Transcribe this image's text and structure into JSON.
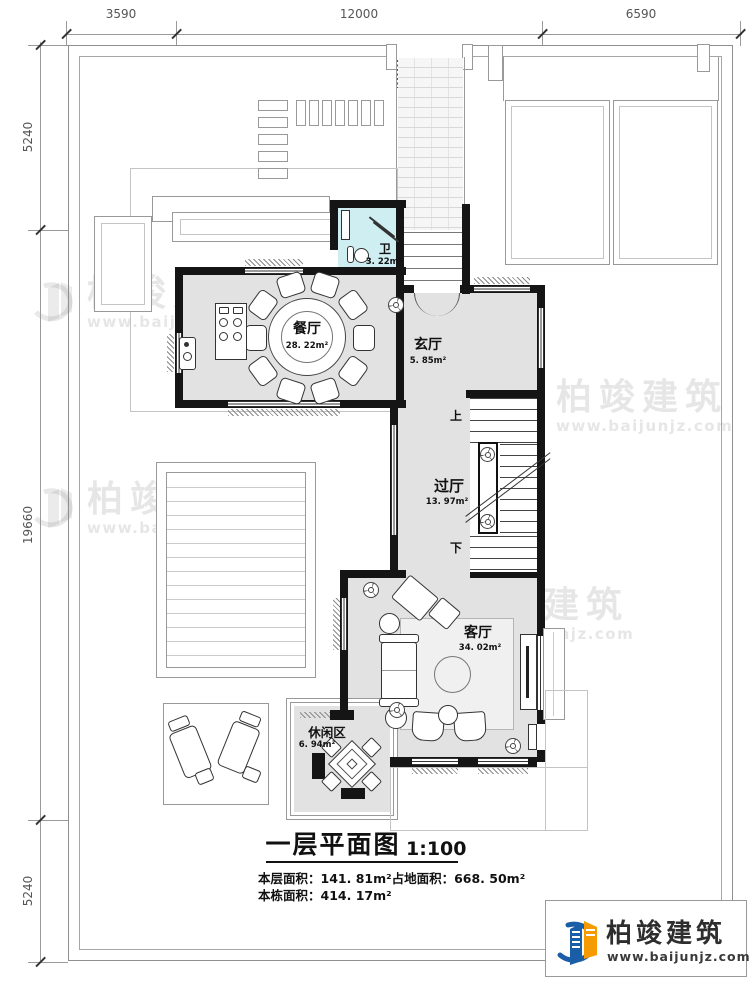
{
  "plan": {
    "dimensions_top": [
      {
        "label": "3590"
      },
      {
        "label": "12000"
      },
      {
        "label": "6590"
      }
    ],
    "dimensions_left": [
      {
        "label": "5240"
      },
      {
        "label": "19660"
      },
      {
        "label": "5240"
      }
    ],
    "rooms": {
      "dining": {
        "name": "餐厅",
        "area": "28. 22m²"
      },
      "bath": {
        "name": "卫",
        "area": "3. 22m²"
      },
      "foyer": {
        "name": "玄厅",
        "area": "5. 85m²"
      },
      "hall": {
        "name": "过厅",
        "area": "13. 97m²"
      },
      "living": {
        "name": "客厅",
        "area": "34. 02m²"
      },
      "leisure": {
        "name": "休闲区",
        "area": "6. 94m²"
      }
    },
    "stairs": {
      "up": "上",
      "down": "下"
    }
  },
  "title": {
    "main": "一层平面图",
    "scale": "1:100",
    "area_line1a": "本层面积：141. 81m²",
    "area_line1b": "占地面积：668. 50m²",
    "area_line2": "本栋面积：414. 17m²"
  },
  "brand": {
    "name": "柏竣建筑",
    "website": "www.baijunjz.com"
  },
  "colors": {
    "wall": "#151515",
    "floor": "#e2e2e2",
    "bath_floor": "#cfeef2",
    "logo_blue": "#1b5ea8",
    "logo_orange": "#f59b00",
    "dim_text": "#555555"
  }
}
